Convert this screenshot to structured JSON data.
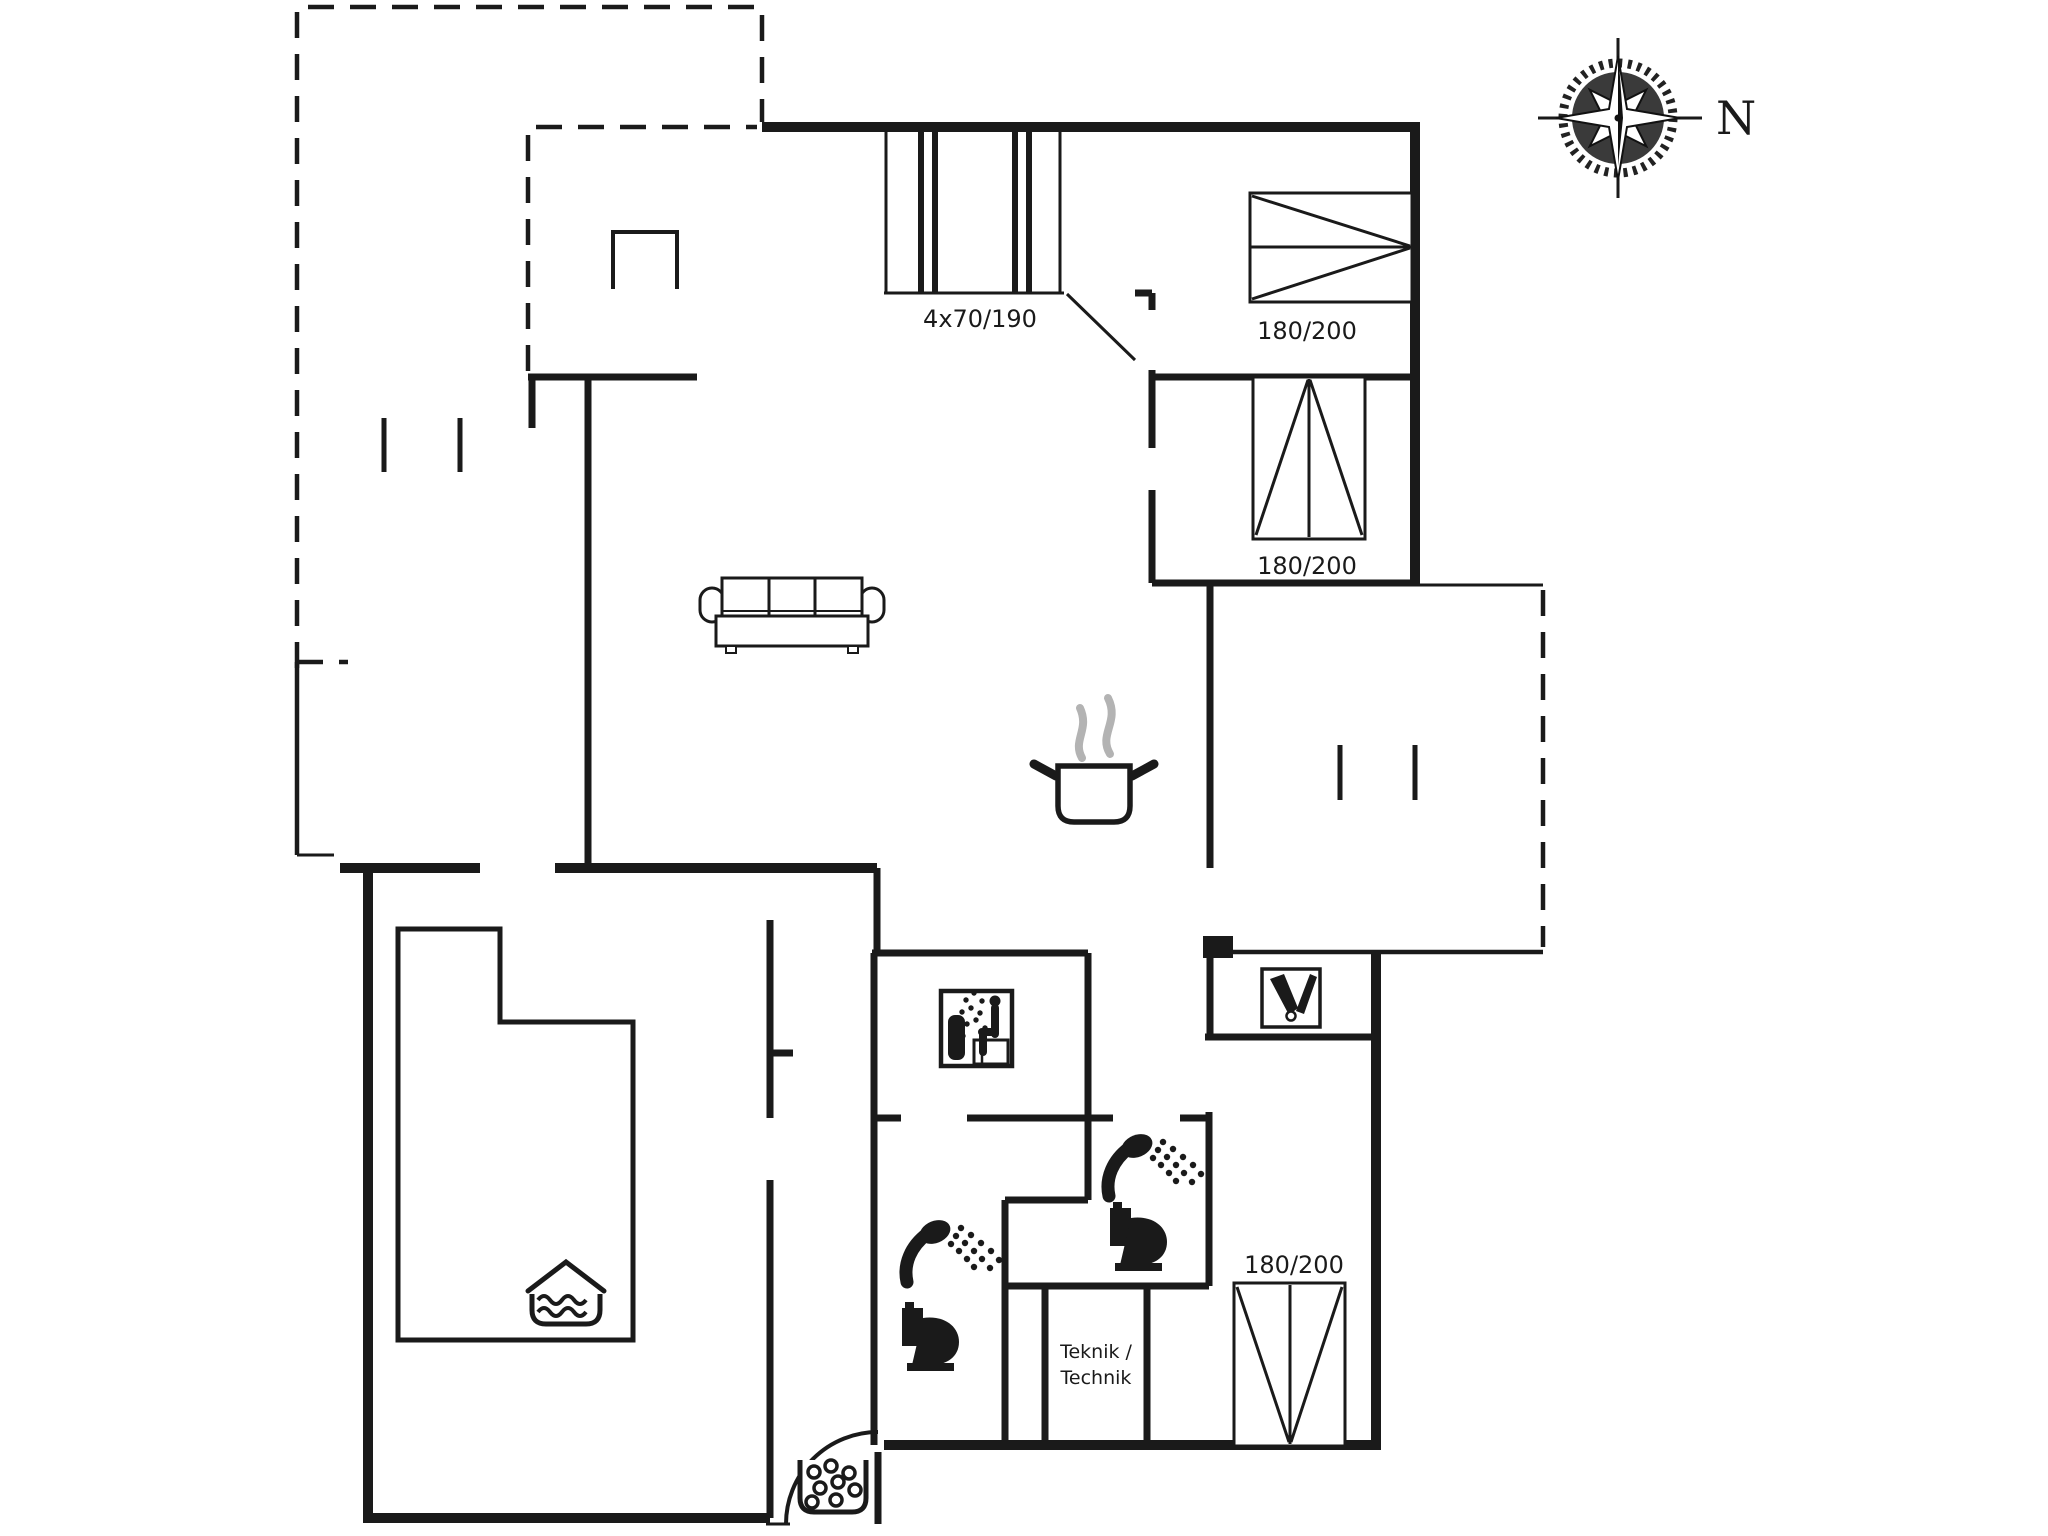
{
  "colors": {
    "ink": "#1a1a1a",
    "steam": "#b3b3b3",
    "paper": "#ffffff"
  },
  "compass": {
    "north_label": "N"
  },
  "labels": {
    "entry_sliding_doors": "4x70/190",
    "bedroom_top_bed": "180/200",
    "bedroom_middle_bed": "180/200",
    "bedroom_bottom_bed": "180/200",
    "technik_line1": "Teknik /",
    "technik_line2": "Technik"
  },
  "icons": {
    "compass": "compass-rose",
    "sofa": "three-seat-sofa",
    "stove": "cooking-pot-with-steam",
    "sauna": "sauna-person-on-bench",
    "shower": "hand-shower-spray",
    "toilet": "toilet",
    "pool": "indoor-pool-water",
    "whirlpool": "bubble-tub",
    "entry_rack": "boot-rack"
  }
}
